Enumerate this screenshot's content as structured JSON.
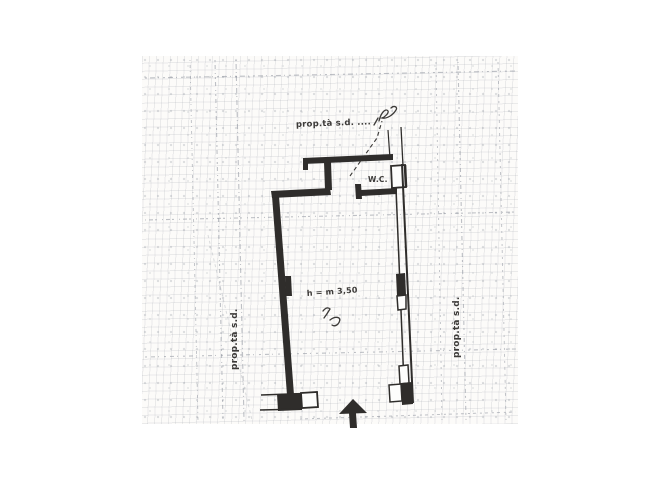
{
  "document": {
    "kind_label": "scanned floor plan sketch",
    "palette": {
      "paper": "#ffffff",
      "scan_paper": "#fcfbf9",
      "ink": "#2f2d2b",
      "handwriting": "#3c3a38",
      "grid_line": "#8a909a"
    }
  },
  "plan": {
    "labels": {
      "boundary_top": "prop.tà s.d. ....",
      "boundary_left": "prop.tà s.d.",
      "boundary_right": "prop.tà s.d.",
      "wc": "W.C.",
      "height_note": "h = m 3,50"
    },
    "icons": {
      "entrance_arrow": "arrow-up"
    }
  }
}
